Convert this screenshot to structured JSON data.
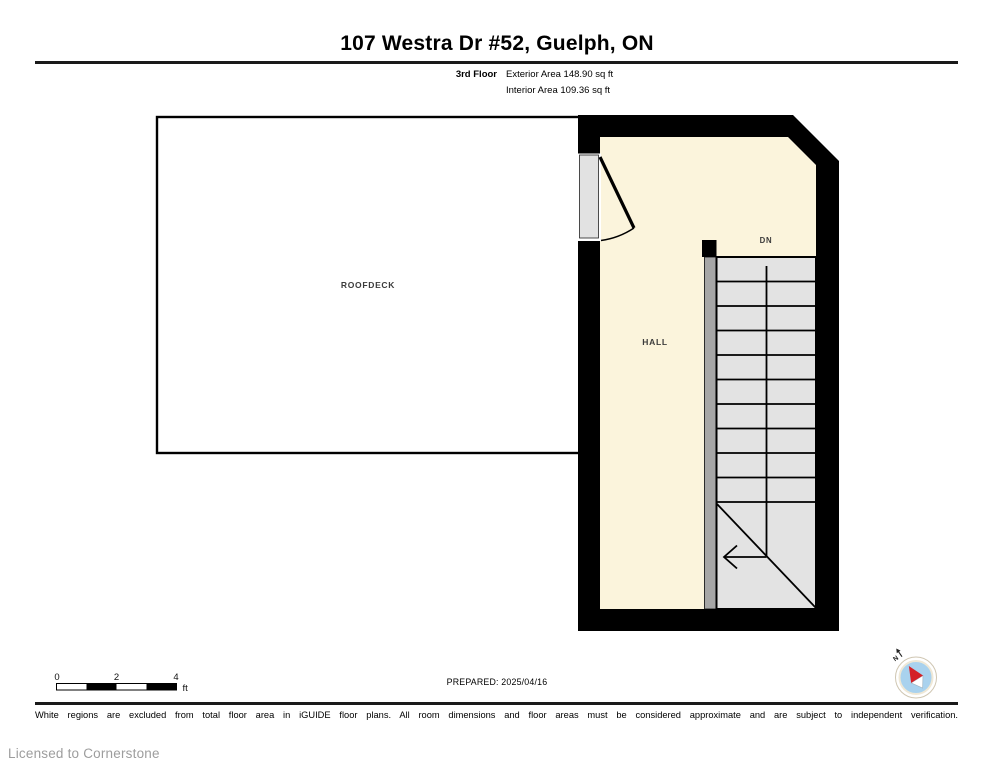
{
  "header": {
    "title": "107 Westra Dr #52, Guelph, ON",
    "floor_label": "3rd Floor",
    "exterior_area": "Exterior Area 148.90 sq ft",
    "interior_area": "Interior Area 109.36 sq ft"
  },
  "plan": {
    "rooms": {
      "roofdeck": "ROOFDECK",
      "hall": "HALL"
    },
    "stairs_direction": "DN"
  },
  "scale_bar": {
    "ticks": [
      "0",
      "2",
      "4"
    ],
    "unit": "ft"
  },
  "compass": {
    "north_label": "N"
  },
  "footer": {
    "prepared": "PREPARED: 2025/04/16",
    "disclaimer": "White regions are excluded from total floor area in iGUIDE floor plans. All room dimensions and floor areas must be considered approximate and are subject to independent verification.",
    "license": "Licensed to Cornerstone"
  },
  "colors": {
    "wall": "#000000",
    "room_fill": "#fbf4dc",
    "stair_fill": "#e3e3e3",
    "stair_stringer": "#a6a6a6",
    "door_slab": "#e2e2e2",
    "compass_blue": "#a9d2ee",
    "needle_red": "#d42127"
  }
}
